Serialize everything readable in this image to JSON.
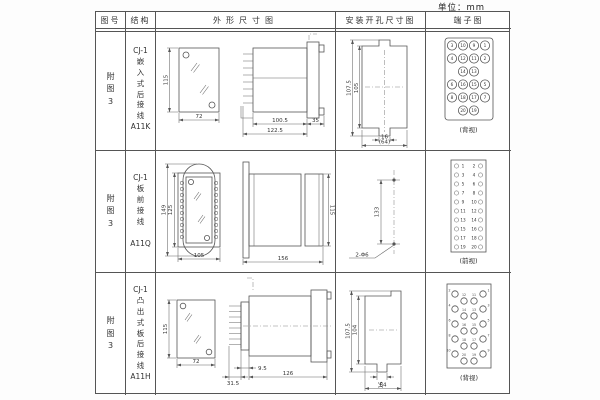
{
  "unit_label": "单位：mm",
  "table": {
    "headers": {
      "fig_no": "图号",
      "structure": "结构",
      "outline": "外形尺寸图",
      "mounting": "安装开孔尺寸图",
      "terminal": "端子图"
    },
    "rows": [
      {
        "fig_no": "附\n图\n3",
        "structure": "CJ-1\n嵌\n入\n式\n后\n接\n线\nA11K",
        "outline": {
          "h": "115",
          "w": "72",
          "body": "100.5",
          "total": "122.5",
          "flange": "35"
        },
        "mounting": {
          "h_outer": "107.5",
          "h_inner": "105",
          "notch": "16",
          "w_total": "(64)"
        },
        "terminal": {
          "caption": "(背视)",
          "grid": [
            [
              "3",
              "10",
              "9",
              "1"
            ],
            [
              "4",
              "12",
              "11",
              "2"
            ],
            [
              "",
              "14",
              "13",
              ""
            ],
            [
              "6",
              "16",
              "15",
              "5"
            ],
            [
              "8",
              "18",
              "17",
              "7"
            ],
            [
              "",
              "20",
              "19",
              ""
            ]
          ]
        }
      },
      {
        "fig_no": "附\n图\n3",
        "structure": "CJ-1\n板\n前\n接\n线\n\nA11Q",
        "outline": {
          "h_outer": "149",
          "h_inner": "125",
          "w": "105",
          "depth": "156",
          "h_side": "115"
        },
        "mounting": {
          "spacing": "133",
          "holes": "2-Φ6"
        },
        "terminal": {
          "caption": "(前视)",
          "left": [
            "1",
            "3",
            "5",
            "7",
            "9",
            "11",
            "13",
            "15",
            "17",
            "19"
          ],
          "right": [
            "2",
            "4",
            "6",
            "8",
            "10",
            "12",
            "14",
            "16",
            "18",
            "20"
          ]
        }
      },
      {
        "fig_no": "附\n图\n3",
        "structure": "CJ-1\n凸\n出\n式\n板\n后\n接\n线\nA11H",
        "outline": {
          "h": "115",
          "w": "72",
          "pin": "31.5",
          "base": "9.5",
          "body": "126"
        },
        "mounting": {
          "h_outer": "107.5",
          "h_inner": "104",
          "notch": "16",
          "w_total": "64"
        },
        "terminal": {
          "caption": "(背视)",
          "left_outer": [
            "2",
            "4",
            "6",
            "8",
            "10"
          ],
          "left_inner": [
            "12",
            "14",
            "16",
            "18",
            "20"
          ],
          "right_inner": [
            "11",
            "13",
            "15",
            "17",
            "19"
          ],
          "right_outer": [
            "1",
            "3",
            "5",
            "7",
            "9"
          ]
        }
      }
    ]
  }
}
